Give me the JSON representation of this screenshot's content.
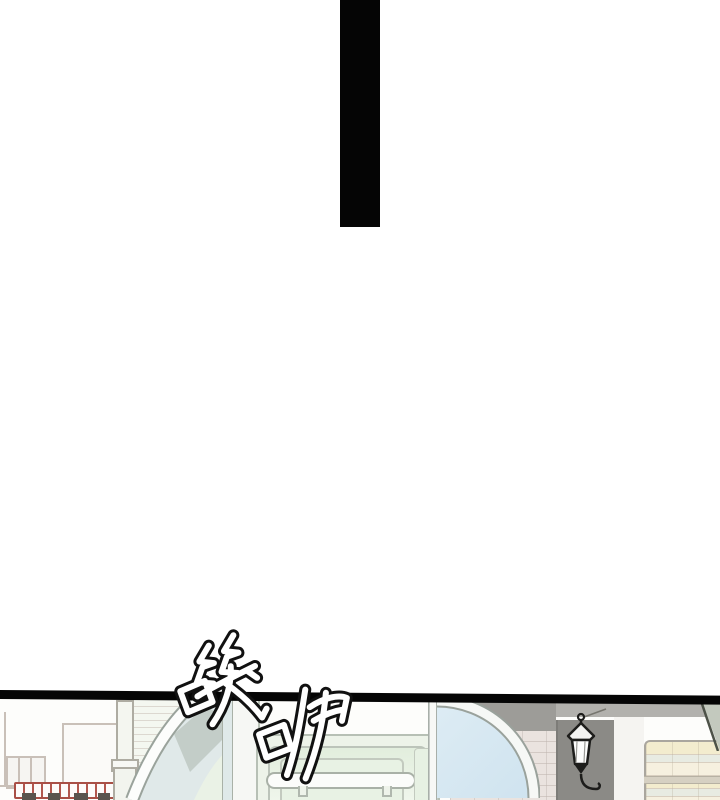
{
  "page": {
    "kind": "webtoon comic panel page",
    "sfx": {
      "text": "嘰咿",
      "characters": [
        "嘰",
        "咿"
      ],
      "style": "hand-drawn outlined calligraphy, slanted, white fill with black outline"
    },
    "scene_description": "Top edge of a street storefront panel: arched glass doors, mint double door, wall lantern on gray column, pink and yellow brick walls, small shops with red striped awning on the left"
  },
  "palette": {
    "page_background": "#ffffff",
    "ink": "#050505",
    "mint_wall": "#edf3e9",
    "door_glass": "#e8f2e4",
    "blue_arch_glass": "#cfe3ef",
    "left_arch_glass": "#e0e9e9",
    "soffit_gray": "#9d9c98",
    "column_gray": "#8b8a86",
    "pink_brick": "#eae3df",
    "yellow_brick": "#f3ecce",
    "awning_red": "#a94f46",
    "roof_edge_green": "#4d5248"
  }
}
